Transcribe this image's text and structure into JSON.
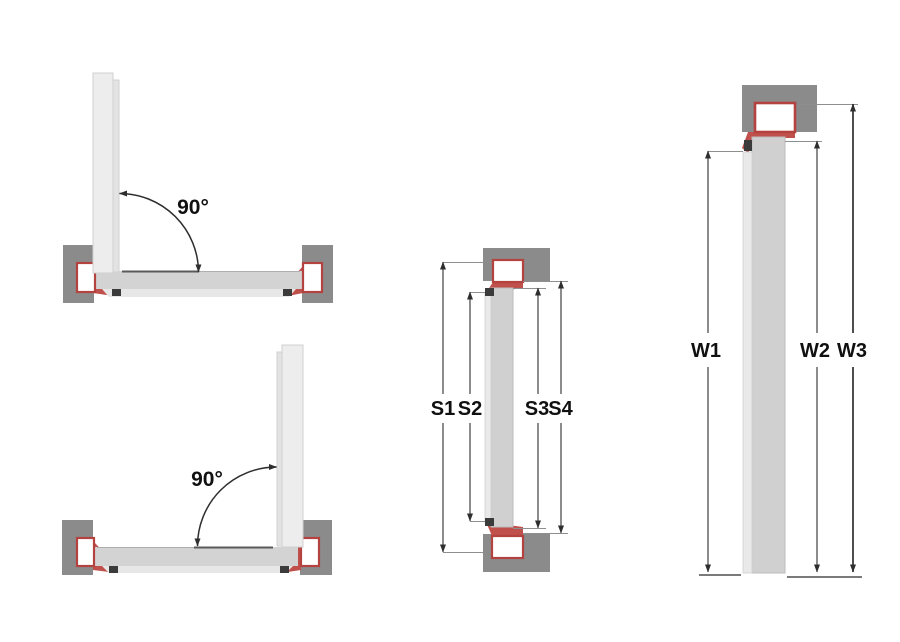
{
  "labels": {
    "angle_top": "90°",
    "angle_bottom": "90°",
    "s1": "S1",
    "s2": "S2",
    "s3": "S3",
    "s4": "S4",
    "w1": "W1",
    "w2": "W2",
    "w3": "W3"
  },
  "colors": {
    "wall_gray": "#8b8b8b",
    "frame_red": "#c0504b",
    "frame_red_border": "#b4433f",
    "door_panel_gray": "#d0d0d0",
    "door_leaf_light": "#ededed",
    "dimension_line": "#3f3f3f",
    "text": "#101010",
    "background": "#ffffff"
  }
}
